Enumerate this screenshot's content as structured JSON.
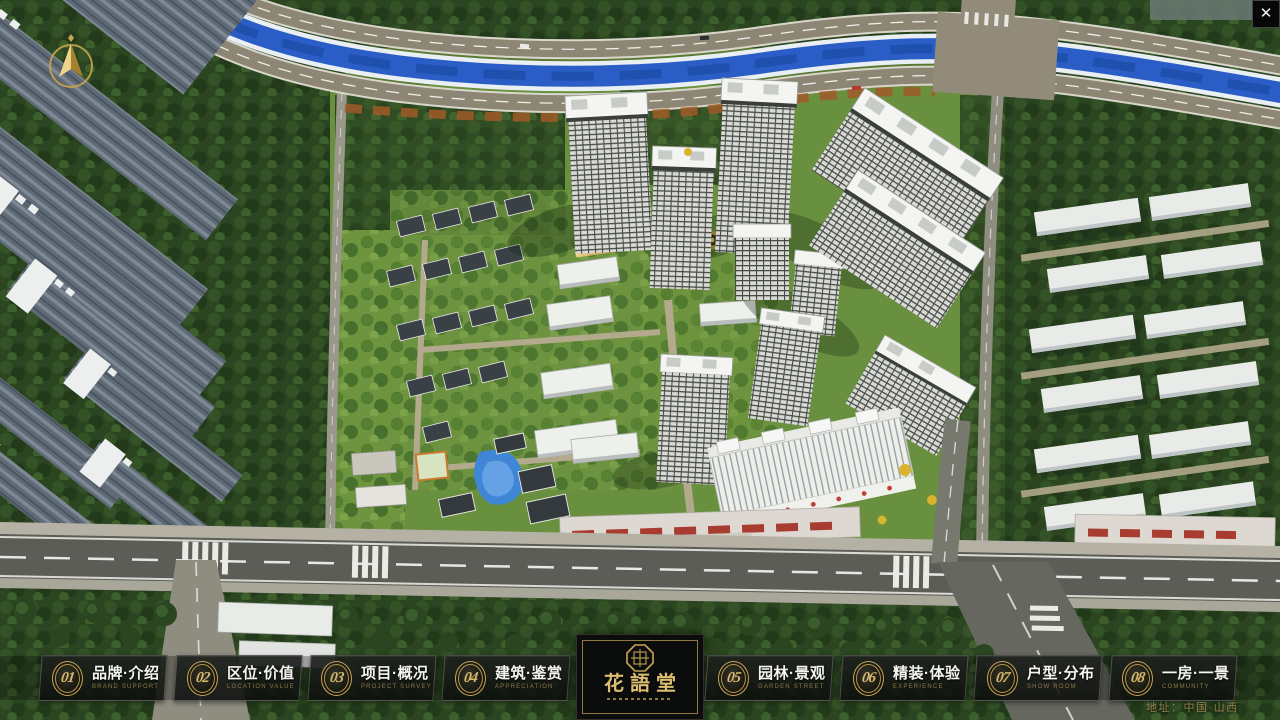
{
  "hud": {
    "close_glyph": "✕",
    "address": "地址：中国·山西"
  },
  "logo": {
    "title": "花語堂"
  },
  "nav": {
    "items": [
      {
        "num": "01",
        "zh": "品牌·介绍",
        "en": "BRAND SUPPORT"
      },
      {
        "num": "02",
        "zh": "区位·价值",
        "en": "LOCATION VALUE"
      },
      {
        "num": "03",
        "zh": "项目·概况",
        "en": "PROJECT SURVEY"
      },
      {
        "num": "04",
        "zh": "建筑·鉴赏",
        "en": "APPRECIATION"
      },
      {
        "num": "05",
        "zh": "园林·景观",
        "en": "GARDEN STREET"
      },
      {
        "num": "06",
        "zh": "精装·体验",
        "en": "EXPERIENCE"
      },
      {
        "num": "07",
        "zh": "户型·分布",
        "en": "SHOW ROOM"
      },
      {
        "num": "08",
        "zh": "一房·一景",
        "en": "COMMUNITY"
      }
    ]
  },
  "colors": {
    "accent_gold": "#c9a558",
    "nav_label": "#f4f4f0",
    "nav_english": "#8d7a45",
    "address_gold": "#97824c",
    "river_blue": "#2a5ec6"
  }
}
